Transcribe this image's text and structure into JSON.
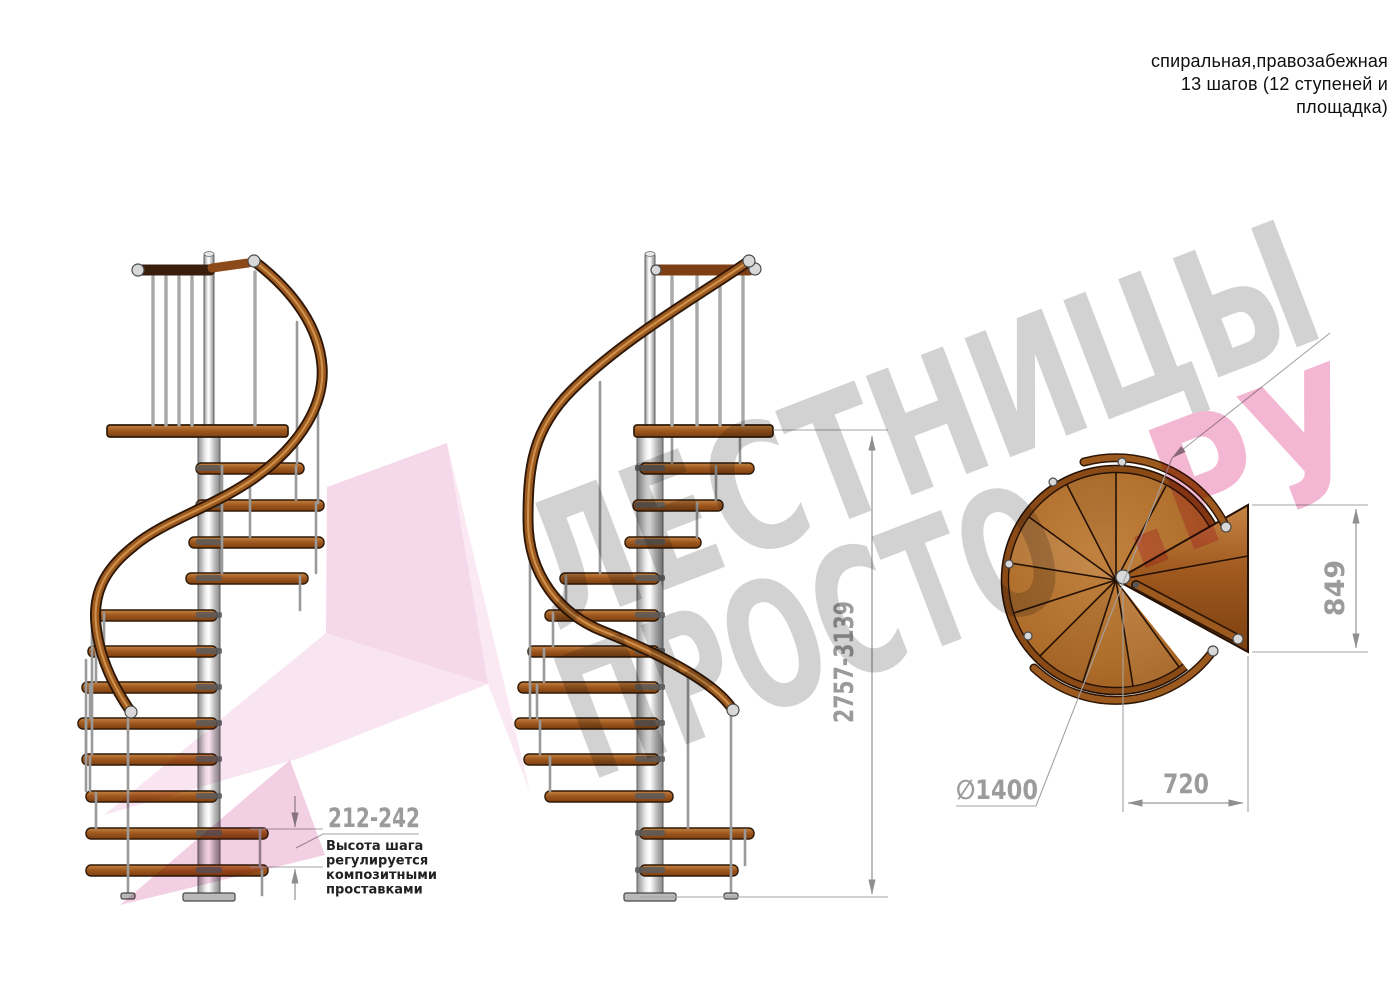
{
  "header": {
    "line1": "спиральная,правозабежная",
    "line2": "13 шагов (12 ступеней и",
    "line3": "площадка)"
  },
  "watermark": {
    "line1": "ЛЕСТНИЦЫ",
    "line2": "ПРОСТО",
    "suffix": ".РУ"
  },
  "dimensions": {
    "step_height": "212-242",
    "total_height": "2757-3139",
    "platform_depth": "849",
    "platform_width": "720",
    "diameter": "∅1400",
    "note": {
      "line1": "Высота шага",
      "line2": "регулируется",
      "line3": "композитными",
      "line4": "проставками"
    }
  },
  "colors": {
    "wood": "#a96a27",
    "wood_dark": "#7c4310",
    "rail_dark": "#3a1e0c",
    "metal": "#c9c9c9",
    "dimension_gray": "#9b9b9b",
    "watermark_gray": "#d2d2d2",
    "watermark_pink": "#f3b7d4",
    "note_black": "#222222"
  }
}
